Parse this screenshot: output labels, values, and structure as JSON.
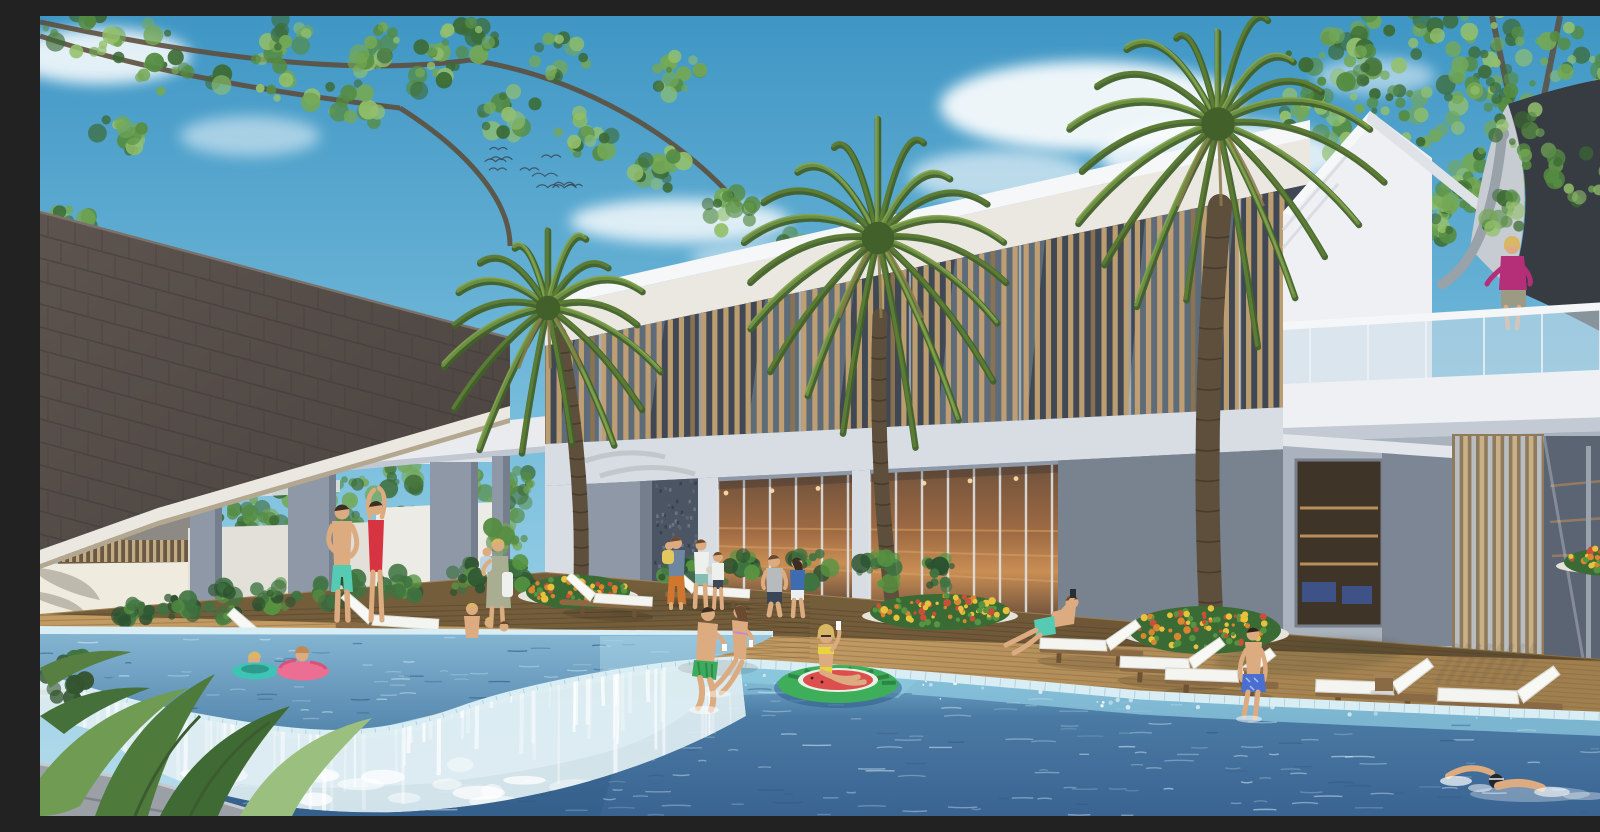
{
  "meta": {
    "title": "Resort clubhouse pool rendering",
    "description": "Daytime architectural rendering of a tropical resort clubhouse: a two-story white building with a wooden-louver upper facade and glass ground floor, three tall fan palms, a dark shingled pavilion roof at left, white sun loungers on a timber deck, a raised kids' pool spilling over an infinity-edge waterfall into a large blue swimming pool, with families walking, lounging, floating on a watermelon ring and swimming."
  },
  "scene": {
    "setting": "resort pool courtyard",
    "time_of_day": "sunny day",
    "people": [
      {
        "id": "standing-man",
        "desc": "man in teal swim shorts standing near kids pool",
        "x": 300,
        "y": 545
      },
      {
        "id": "standing-woman",
        "desc": "woman in red one-piece swimsuit, arms raised",
        "x": 335,
        "y": 540
      },
      {
        "id": "woman-with-baby",
        "desc": "woman in sage wrap holding a baby",
        "x": 456,
        "y": 565
      },
      {
        "id": "family-walking",
        "desc": "father in orange pants carrying child, mother and boy",
        "x": 650,
        "y": 555
      },
      {
        "id": "couple-walking",
        "desc": "man in gray tee and woman in blue top walking on deck",
        "x": 745,
        "y": 570
      },
      {
        "id": "seated-couple",
        "desc": "couple sitting on pool edge with drinks, feet in water",
        "x": 685,
        "y": 630
      },
      {
        "id": "float-woman",
        "desc": "woman in yellow bikini on watermelon swim ring",
        "x": 798,
        "y": 645
      },
      {
        "id": "kids-pool-mother",
        "desc": "mother with two children in kids pool",
        "x": 445,
        "y": 605
      },
      {
        "id": "kids-swim-rings",
        "desc": "two children in teal and pink swim rings",
        "x": 240,
        "y": 648
      },
      {
        "id": "lounging-man",
        "desc": "man in teal shorts reclined on a lounger with phone",
        "x": 1010,
        "y": 605
      },
      {
        "id": "boy-pool-edge",
        "desc": "boy in blue trunks sitting on pool edge",
        "x": 1213,
        "y": 655
      },
      {
        "id": "swimmer",
        "desc": "freestyle swimmer with dark cap and goggles",
        "x": 1455,
        "y": 765
      },
      {
        "id": "balcony-woman",
        "desc": "woman in magenta top at upstairs glass balcony",
        "x": 1472,
        "y": 265
      }
    ],
    "objects": {
      "palm_trees": 3,
      "sun_loungers": 12,
      "side_tables": 2,
      "swim_rings": [
        "teal",
        "pink",
        "watermelon float"
      ],
      "pools": [
        "raised kids pool with infinity waterfall",
        "large main pool"
      ],
      "pavilion": "dark shingled A-frame roof with pergola and columns",
      "canopy": "dark tensile sail over upper balcony",
      "birds": 11
    }
  },
  "generators": {
    "seed": 20240612,
    "birds": {
      "x": 425,
      "y": 112,
      "w": 118,
      "h": 62,
      "count": 11
    },
    "slats": {
      "x0": 508,
      "x1": 1242,
      "n": 66
    },
    "shingleRows": 17,
    "ripplesMain": 240,
    "ripplesKids": 90,
    "sparkles": 70,
    "cascadeStreaks": 80,
    "palms": [
      {
        "name": "palm-left",
        "cx": 508,
        "cy": 292,
        "r": 112,
        "fronds": 17,
        "trunk": {
          "bx": 541,
          "by": 566,
          "tx": 519,
          "ty": 318,
          "w": 15,
          "bend": 14
        }
      },
      {
        "name": "palm-center",
        "cx": 838,
        "cy": 222,
        "r": 148,
        "fronds": 19,
        "trunk": {
          "bx": 853,
          "by": 592,
          "tx": 840,
          "ty": 300,
          "w": 15,
          "bend": -12
        }
      },
      {
        "name": "palm-right",
        "cx": 1178,
        "cy": 108,
        "r": 152,
        "fronds": 19,
        "trunk": {
          "bx": 1172,
          "by": 616,
          "tx": 1180,
          "ty": 190,
          "w": 24,
          "bend": -16
        }
      }
    ],
    "leafTopLeft": [
      [
        40,
        18,
        40
      ],
      [
        120,
        40,
        46
      ],
      [
        215,
        60,
        44
      ],
      [
        310,
        85,
        40
      ],
      [
        395,
        55,
        38
      ],
      [
        470,
        95,
        34
      ],
      [
        545,
        120,
        30
      ],
      [
        620,
        155,
        28
      ],
      [
        690,
        195,
        26
      ],
      [
        745,
        235,
        22
      ],
      [
        640,
        60,
        26
      ],
      [
        520,
        40,
        28
      ],
      [
        240,
        12,
        34
      ],
      [
        80,
        120,
        26
      ],
      [
        30,
        210,
        24
      ],
      [
        60,
        300,
        20
      ],
      [
        105,
        395,
        22
      ],
      [
        50,
        470,
        20
      ],
      [
        330,
        30,
        30
      ],
      [
        430,
        20,
        26
      ]
    ],
    "leafTopRight": [
      [
        1290,
        35,
        42
      ],
      [
        1360,
        22,
        46
      ],
      [
        1440,
        15,
        44
      ],
      [
        1515,
        30,
        46
      ],
      [
        1575,
        70,
        42
      ],
      [
        1595,
        140,
        36
      ],
      [
        1540,
        110,
        40
      ],
      [
        1460,
        85,
        42
      ],
      [
        1385,
        95,
        40
      ],
      [
        1310,
        120,
        36
      ],
      [
        1280,
        185,
        30
      ],
      [
        1350,
        165,
        34
      ],
      [
        1430,
        160,
        36
      ],
      [
        1500,
        165,
        34
      ],
      [
        1560,
        200,
        30
      ],
      [
        1335,
        70,
        36
      ],
      [
        1260,
        90,
        30
      ],
      [
        1395,
        205,
        26
      ],
      [
        1420,
        180,
        22
      ]
    ],
    "leafOverlay": [
      [
        1488,
        120,
        38
      ],
      [
        1540,
        160,
        34
      ],
      [
        1470,
        200,
        28
      ],
      [
        1592,
        228,
        28
      ],
      [
        1445,
        60,
        32
      ]
    ],
    "leafBgLeft": [
      [
        95,
        492,
        24
      ],
      [
        145,
        472,
        26
      ],
      [
        200,
        490,
        28
      ],
      [
        255,
        470,
        26
      ],
      [
        310,
        482,
        28
      ],
      [
        365,
        462,
        24
      ],
      [
        420,
        472,
        26
      ],
      [
        465,
        492,
        22
      ],
      [
        230,
        516,
        22
      ],
      [
        300,
        512,
        20
      ],
      [
        360,
        505,
        18
      ],
      [
        60,
        505,
        18
      ],
      [
        480,
        470,
        20
      ]
    ],
    "shrubRow": [
      [
        185,
        588,
        26
      ],
      [
        235,
        580,
        28
      ],
      [
        300,
        574,
        30
      ],
      [
        360,
        568,
        26
      ],
      [
        425,
        563,
        26
      ],
      [
        480,
        560,
        22
      ],
      [
        640,
        557,
        24
      ],
      [
        700,
        554,
        26
      ],
      [
        770,
        552,
        28
      ],
      [
        840,
        553,
        26
      ],
      [
        900,
        557,
        24
      ],
      [
        95,
        594,
        24
      ],
      [
        140,
        590,
        22
      ]
    ],
    "loungersLeft": [
      [
        715,
        566,
        0.78
      ],
      [
        618,
        573,
        0.84
      ],
      [
        405,
        594,
        0.95
      ],
      [
        300,
        612,
        1.03
      ],
      [
        150,
        636,
        1.12
      ],
      [
        60,
        652,
        1.18
      ]
    ],
    "loungersRight": [
      [
        995,
        612,
        0.96
      ],
      [
        1075,
        630,
        1.0
      ],
      [
        1120,
        641,
        1.05
      ],
      [
        1270,
        652,
        1.12
      ],
      [
        1392,
        660,
        1.16
      ],
      [
        1565,
        672,
        1.22
      ]
    ],
    "tables": [
      [
        1212,
        657,
        0.9
      ],
      [
        1344,
        664,
        1.0
      ]
    ]
  },
  "colors": {
    "skyTop": "#3f96c4",
    "skyMid": "#7cc0de",
    "skyLow": "#b7ddec",
    "cloud": "#ffffff",
    "foliageDark": "#3c6a33",
    "foliage": "#558c42",
    "foliageLight": "#74a855",
    "foliagePale": "#93c06c",
    "branch": "#5d4f3d",
    "roof": "#5d544f",
    "roofDark": "#4a433f",
    "roofLine": "#423b37",
    "fascia": "#ebe8e2",
    "fasciaShade": "#b3a88f",
    "wallWhite": "#eef0f3",
    "wallBright": "#f6f7f8",
    "wallShade": "#d8dce3",
    "wallCool": "#bfc6d1",
    "colGray": "#8e98a6",
    "colDark": "#747e8c",
    "mosaic": "#4c5564",
    "slat": "#c2a172",
    "slatDark": "#8d7350",
    "slatGap": "#3f4854",
    "glassSky": "#a4bfd2",
    "glassWarm": "#a06b43",
    "glassWarmDark": "#6f523c",
    "glassLight": "#c98e54",
    "lamp": "#ffd9a0",
    "mullion": "#dfe3e6",
    "interiorShelf": "#d9a468",
    "couchBlue": "#3e5288",
    "canopyDark": "#363c42",
    "canopySail": "#c6ccd2",
    "mast": "#99a1a9",
    "railGlass": "#ccdde8",
    "slabWhite": "#eef0f3",
    "louver": "#c8b089",
    "louverDark": "#8f7b5c",
    "deck": "#c29b63",
    "deckShade": "#a07f4e",
    "deckLine": "#83683f",
    "stone": "#9aa0a6",
    "stoneLight": "#c6cacd",
    "coping": "#d9edf4",
    "copingLine": "#a3c8d6",
    "tileLight": "#8ecadf",
    "tilePale": "#b9e2ee",
    "poolTop": "#7db4d6",
    "poolMid": "#4a7aa3",
    "poolDeep": "#3a6392",
    "poolDark": "#2f5880",
    "kidsTop": "#83b5d2",
    "kidsDeep": "#5586ad",
    "ripple": "#cde3f0",
    "rippleDark": "#2e567f",
    "foam": "#ffffff",
    "skin": "#dcab80",
    "skinShade": "#c4905f",
    "hairDark": "#3c2e22",
    "hairBrown": "#6b4a2f",
    "hairBlonde": "#d9b765",
    "tealShorts": "#54cbb2",
    "redSuit": "#d63440",
    "sageDress": "#a9ae92",
    "babyBlue": "#bcd3e2",
    "orangePants": "#d0762f",
    "blueTop": "#3f6cb0",
    "whiteCloth": "#eef0ee",
    "grayTee": "#b7bbbd",
    "navyShorts": "#394658",
    "greenTrunks": "#3cab5e",
    "yellowBikini": "#e8d53e",
    "floatGreen": "#3fae5a",
    "floatGreenDark": "#2e8546",
    "floatRed": "#dd4f4f",
    "ringTeal": "#3ec4b4",
    "ringPink": "#ec6e93",
    "ringPinkDark": "#d8537b",
    "magenta": "#b52e78",
    "balconyShorts": "#9a9a85",
    "boyShorts": "#4a6fd0",
    "capDark": "#20262c",
    "cushion": "#f4f4f1",
    "cushionBright": "#f8f8f5",
    "cushionShade": "#d9d9d2",
    "chairWood": "#8a6a45",
    "chairWoodDark": "#6d5334",
    "shrub": "#2c5230",
    "shrubMid": "#3f7341",
    "shrubLight": "#579441",
    "flowerYellow": "#e9c23d",
    "flowerOrange": "#d8862f",
    "flowerRed": "#c8503a",
    "planterCurb": "#e7e3da",
    "shadow": "#2e2c20",
    "birdColor": "#37424c"
  }
}
